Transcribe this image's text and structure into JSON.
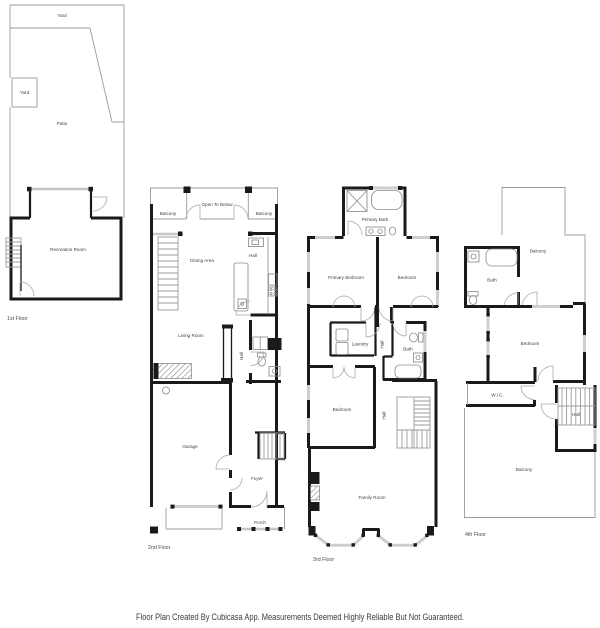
{
  "title": "Floor Plan",
  "floors": [
    {
      "label": "1st Floor",
      "rooms": {
        "yard_top": "Yard",
        "yard_side": "Yard",
        "patio": "Patio",
        "recreation_room": "Recreation Room"
      }
    },
    {
      "label": "2nd Floor",
      "rooms": {
        "balcony_left": "Balcony",
        "open_to_below": "Open To Below",
        "balcony_right": "Balcony",
        "dining_area": "Dining Area",
        "hall_kitchen": "Hall",
        "living_room": "Living Room",
        "hall_mid": "Hall",
        "garage": "Garage",
        "foyer": "Foyer",
        "porch": "Porch"
      }
    },
    {
      "label": "3rd Floor",
      "rooms": {
        "primary_bath": "Primary Bath",
        "primary_bedroom": "Primary Bedroom",
        "bedroom_right": "Bedroom",
        "laundry": "Laundry",
        "hall_upper": "Hall",
        "bath": "Bath",
        "bedroom_lower": "Bedroom",
        "hall_lower": "Hall",
        "family_room": "Family Room"
      }
    },
    {
      "label": "4th Floor",
      "rooms": {
        "balcony_top": "Balcony",
        "bath": "Bath",
        "bedroom": "Bedroom",
        "wic": "W.I.C.",
        "hall": "Hall",
        "balcony_bottom": "Balcony"
      }
    }
  ],
  "footer": {
    "disclaimer": "Floor Plan Created By Cubicasa App. Measurements Deemed Highly Reliable But Not Guaranteed."
  },
  "colors": {
    "wall": "#1a1a1a",
    "thin_line": "#9b9b9b",
    "window": "#cfcfcf",
    "label": "#3f3f3f",
    "background": "#ffffff"
  }
}
